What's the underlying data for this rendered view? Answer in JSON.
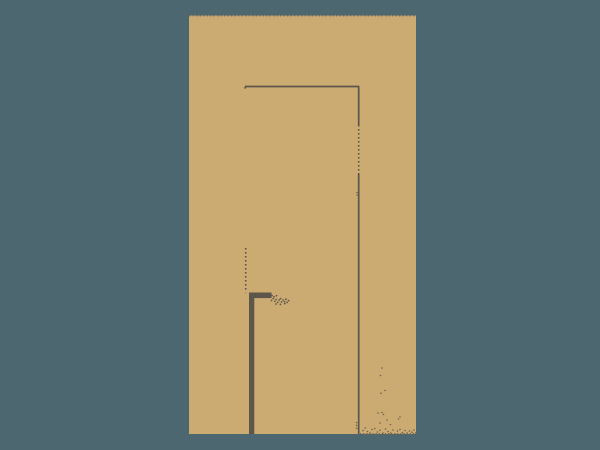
{
  "scene": {
    "background_color": "#4d6771",
    "ink": {
      "line_color": "#5d564b",
      "dot_color": "#6b6150",
      "border_dot_color": "#6f695b"
    },
    "wall": {
      "fill": "#ccab73",
      "x": 189,
      "y": 15.5,
      "width": 227,
      "height": 418.5,
      "top_edge": {
        "x1": 189,
        "y1": 15.6,
        "x2": 416,
        "y2": 15.6
      },
      "bottom_dashed_edge": {
        "x1": 360,
        "y1": 433.8,
        "x2": 416,
        "y2": 433.8
      }
    },
    "door": {
      "frame_top": {
        "x1": 245,
        "y1": 86.5,
        "x2": 359.3,
        "y2": 86.5
      },
      "corner_tick": {
        "x": 244.3,
        "y": 86.8,
        "width": 1.8,
        "height": 1.8
      },
      "frame_right": {
        "x": 358.7,
        "top": 86.5,
        "solid1_end": 125,
        "dotted_end": 173,
        "bottom": 434
      },
      "hinge_dotted": {
        "x": 245.7,
        "y1": 248,
        "y2": 292.3
      },
      "leaf_edge": {
        "x": 249,
        "y": 292.5,
        "width": 5.3,
        "height": 141.5
      },
      "handle": {
        "x": 249,
        "y": 292.5,
        "width": 22.5,
        "height": 5.6
      }
    },
    "texture": {
      "handle_stipple": [
        [
          272,
          295.5
        ],
        [
          274,
          296.8
        ],
        [
          276.5,
          295.8
        ],
        [
          271.5,
          300.5
        ],
        [
          273.2,
          298.6
        ],
        [
          274.8,
          301.4
        ],
        [
          276.2,
          299.5
        ],
        [
          277.8,
          302.4
        ],
        [
          279.2,
          300
        ],
        [
          280.6,
          298.6
        ],
        [
          281.6,
          302
        ],
        [
          283.2,
          300
        ],
        [
          284.6,
          301.6
        ],
        [
          286,
          299.2
        ],
        [
          287.2,
          302.4
        ],
        [
          288.6,
          300.6
        ],
        [
          276,
          304
        ],
        [
          280.4,
          304.4
        ],
        [
          284.8,
          303.6
        ]
      ],
      "scatter_dots": [
        [
          357,
          192.5
        ],
        [
          357.2,
          195
        ],
        [
          356.6,
          422.5
        ],
        [
          356.6,
          425.4
        ],
        [
          356.6,
          428.3
        ],
        [
          382,
          368
        ],
        [
          380.5,
          375.5
        ],
        [
          385,
          390.5
        ],
        [
          381,
          393.2
        ],
        [
          378,
          413
        ],
        [
          382,
          412.5
        ],
        [
          383.5,
          414.5
        ],
        [
          400,
          417
        ],
        [
          398.5,
          419
        ],
        [
          387,
          420
        ],
        [
          380,
          423
        ],
        [
          390.5,
          424.5
        ],
        [
          363,
          430.5
        ],
        [
          365.2,
          428
        ],
        [
          367.5,
          431.5
        ],
        [
          370,
          433
        ],
        [
          372,
          429.5
        ],
        [
          374.8,
          428.5
        ],
        [
          377.5,
          432
        ],
        [
          380,
          430.2
        ],
        [
          383,
          433
        ],
        [
          385.5,
          429
        ],
        [
          388,
          431.5
        ],
        [
          390.5,
          433
        ],
        [
          393,
          430
        ],
        [
          395.2,
          434
        ],
        [
          397.5,
          431
        ],
        [
          400,
          429.5
        ],
        [
          402.5,
          432.5
        ],
        [
          405,
          430.5
        ],
        [
          407,
          433
        ],
        [
          409.5,
          431
        ],
        [
          412,
          432.2
        ],
        [
          414,
          430
        ],
        [
          415.5,
          433
        ],
        [
          368,
          434.5
        ],
        [
          386,
          434.8
        ],
        [
          403,
          434.6
        ]
      ]
    }
  }
}
